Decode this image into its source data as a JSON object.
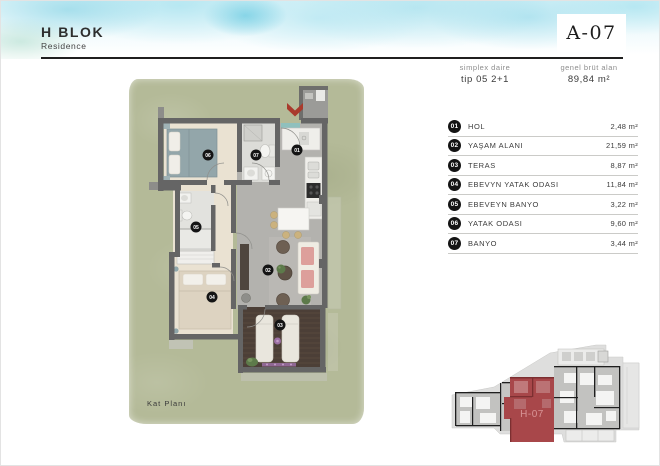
{
  "header": {
    "block_title": "H BLOK",
    "block_subtitle": "Residence",
    "unit_code": "A-07"
  },
  "unit_info": {
    "type_label": "simplex daire",
    "type_value": "tip 05 2+1",
    "area_label": "genel brüt alan",
    "area_value": "89,84 m²"
  },
  "rooms": [
    {
      "no": "01",
      "name": "HOL",
      "area": "2,48 m²"
    },
    {
      "no": "02",
      "name": "YAŞAM ALANI",
      "area": "21,59 m²"
    },
    {
      "no": "03",
      "name": "TERAS",
      "area": "8,87 m²"
    },
    {
      "no": "04",
      "name": "EBEVYN YATAK ODASI",
      "area": "11,84 m²"
    },
    {
      "no": "05",
      "name": "EBEVEYN BANYO",
      "area": "3,22 m²"
    },
    {
      "no": "06",
      "name": "YATAK ODASI",
      "area": "9,60 m²"
    },
    {
      "no": "07",
      "name": "BANYO",
      "area": "3,44 m²"
    }
  ],
  "plan": {
    "caption": "Kat Planı",
    "markers": [
      {
        "label": "01"
      },
      {
        "label": "02"
      },
      {
        "label": "03"
      },
      {
        "label": "04"
      },
      {
        "label": "05"
      },
      {
        "label": "06"
      },
      {
        "label": "07"
      }
    ]
  },
  "site_plan": {
    "highlight_label": "H-07"
  },
  "colors": {
    "accent_red": "#a93a2c",
    "grass_green": "#b4ba98",
    "highlight_unit_red": "#a8474a",
    "wall_gray": "#656565",
    "deck_brown": "#4c3f37"
  }
}
